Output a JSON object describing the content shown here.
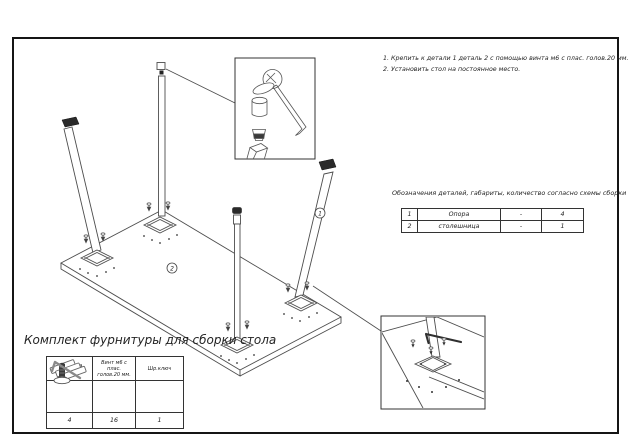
{
  "instructions": {
    "line1": "1. Крепить к детали 1 деталь 2 с помощью винта м6 с плас. голов.20 мм.",
    "line2": "2. Установить стол на постоянное место."
  },
  "parts_table": {
    "title": "Обозначения деталей, габариты, количество согласно схемы сборки",
    "rows": [
      {
        "num": "1",
        "name": "Опора",
        "dims": "-",
        "qty": "4"
      },
      {
        "num": "2",
        "name": "столешница",
        "dims": "-",
        "qty": "1"
      }
    ]
  },
  "kit": {
    "title": "Комплект фурнитуры для сборки стола",
    "columns": [
      {
        "header": "Заглушка\nдля трубы",
        "icon": "pipe-plug-icon",
        "qty": "4"
      },
      {
        "header": "Винт м6 с плас.\nголов.20 мм.",
        "icon": "screw-icon",
        "qty": "16"
      },
      {
        "header": "Шр.ключ",
        "icon": "hex-key-icon",
        "qty": "1"
      }
    ]
  },
  "diagram": {
    "part1_label": "1",
    "part2_label": "2"
  },
  "colors": {
    "line": "#4d4d4d",
    "dark": "#242424",
    "frame": "#151515"
  }
}
